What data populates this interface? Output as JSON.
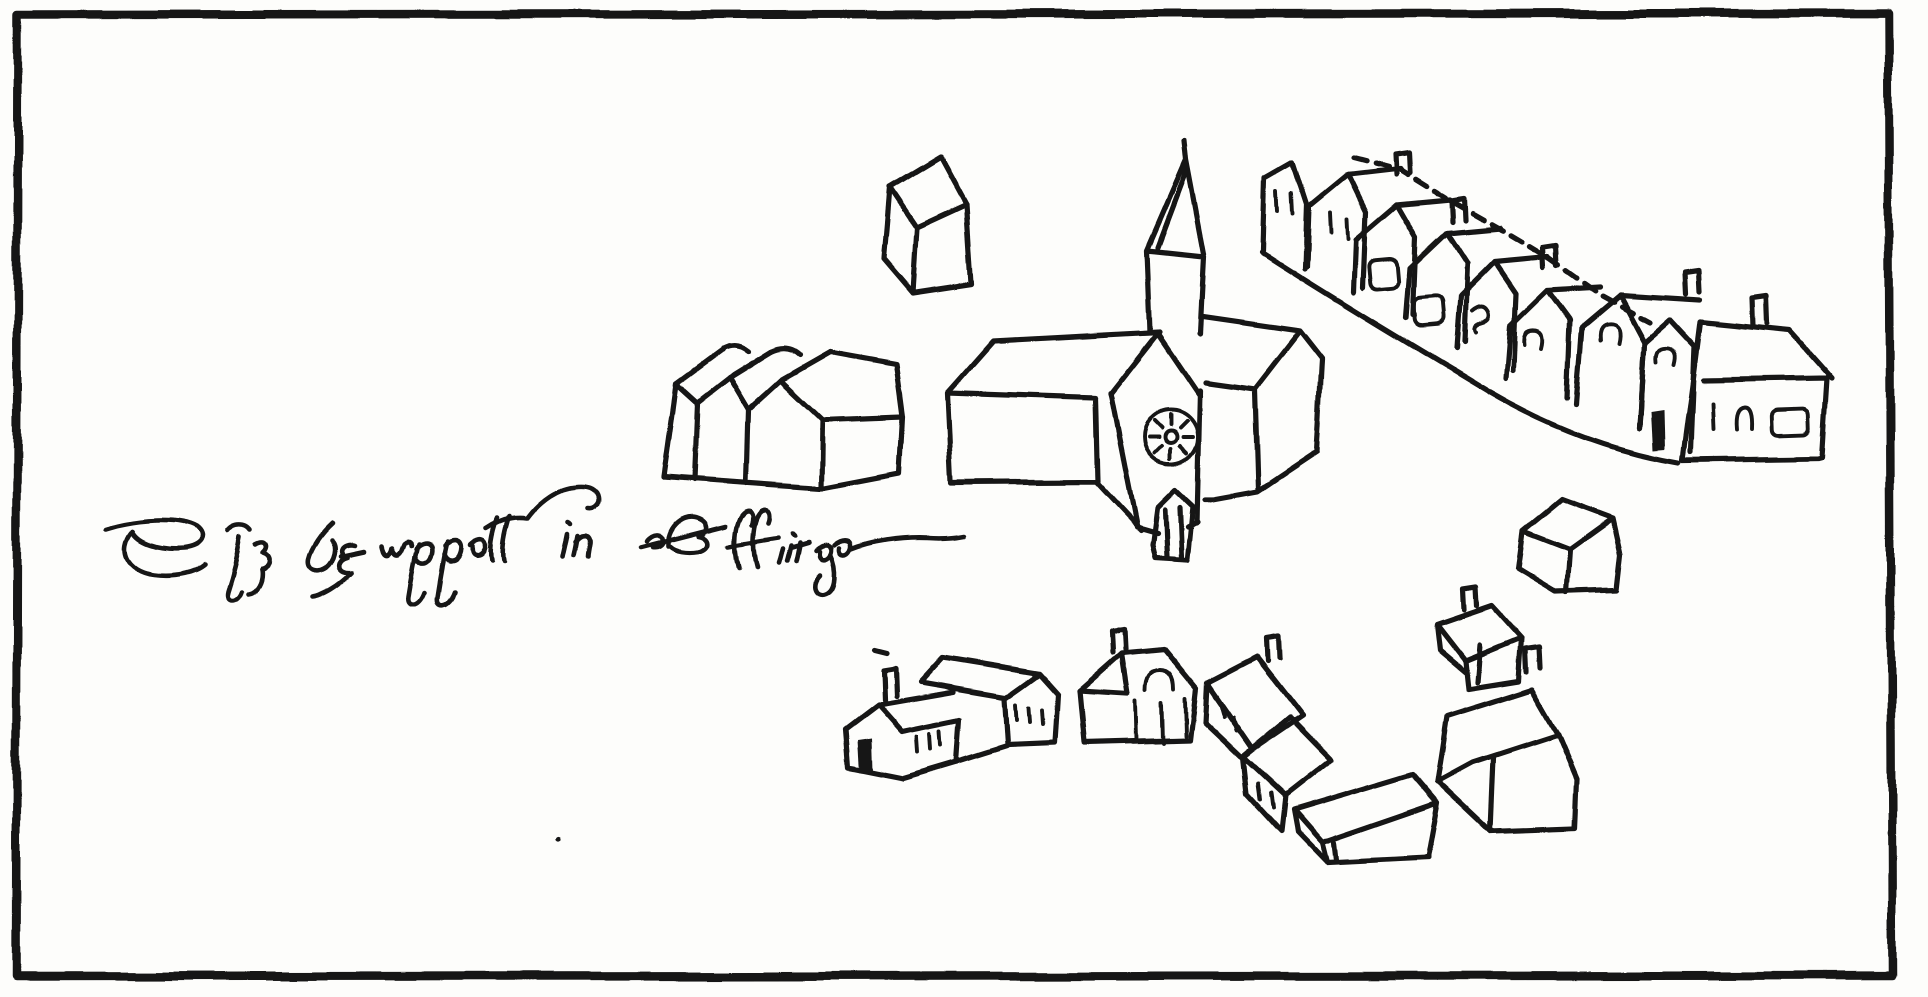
{
  "caption": {
    "transcription": "The chappell in the ffrith",
    "script": "Elizabethan secretary hand, pen flourish over the second word and a long terminal dash"
  },
  "colors": {
    "ink": "#191919",
    "paper": "#fdfdfb"
  },
  "border": {
    "style": "rough hand-inked rectangular frame around the whole sketch"
  },
  "buildings": [
    {
      "id": "lone-house-north",
      "description": "small detached gabled house north-west of the church spire"
    },
    {
      "id": "triple-gabled-building",
      "description": "building with three gable fronts and a long side roof, west of the church"
    },
    {
      "id": "church",
      "description": "church with long nave, central tower bearing a clock face, tall spire, small gabled porch and chancel wing to the east"
    },
    {
      "id": "terraced-row-northeast",
      "description": "diagonal row of gabled houses with chimneys and small windows descending to the south-east, ending in a larger house with three windows"
    },
    {
      "id": "cottage-southwest",
      "description": "cottage with dark doorway, three windows and a chimney"
    },
    {
      "id": "barn-behind-cottage",
      "description": "long barn with three windows in its gable end, behind the cottage"
    },
    {
      "id": "house-with-arched-door",
      "description": "house with arched opening, three tall openings and a chimney"
    },
    {
      "id": "gabled-house-middle",
      "description": "gabled house with chimney and two windows"
    },
    {
      "id": "gabled-house-lower",
      "description": "attached gabled house with two windows"
    },
    {
      "id": "open-barn",
      "description": "low open-fronted barn seen from above"
    },
    {
      "id": "small-cottage-east",
      "description": "small cottage with chimney"
    },
    {
      "id": "large-house-southeast",
      "description": "large tilted gabled house with chimney"
    },
    {
      "id": "lone-house-east",
      "description": "small detached house east of the church"
    }
  ],
  "church_clock": {
    "shown": true,
    "style": "circular dial with radial marks and a small centre boss"
  }
}
